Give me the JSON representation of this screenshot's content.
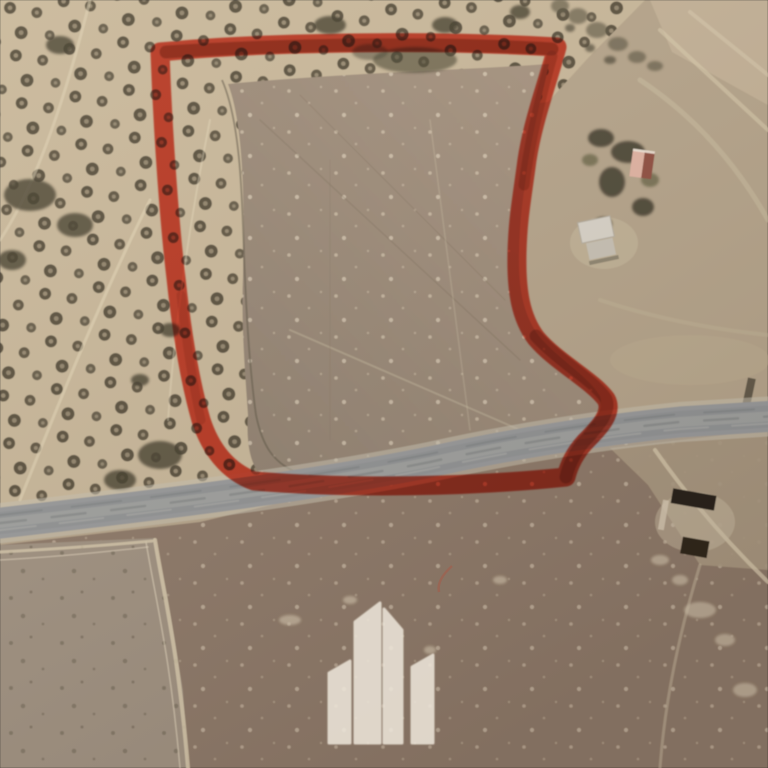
{
  "image": {
    "kind": "satellite-aerial-photo",
    "description": "Aerial view of farmland and olive groves with a red hand-drawn land parcel boundary, a grey rural road, and a white buildings watermark logo"
  },
  "parcel": {
    "path": "M 160 52 C 250 43, 420 39, 557 47 C 549 78, 533 120, 527 160 C 521 205, 518 218, 517 252 C 516 292, 521 318, 536 338 C 556 362, 592 380, 606 399 C 614 413, 598 429, 585 442 C 575 453, 569 465, 566 477 C 470 487, 350 489, 254 481 C 227 471, 210 448, 201 420 C 189 378, 181 325, 176 278 C 170 228, 163 138, 160 52 Z",
    "color": "#e8402a",
    "shadow_color": "#7e1a06",
    "stroke_width": 19
  },
  "road": {
    "path": "M -8 524 C 150 506, 300 488, 430 462 C 510 444, 600 430, 680 422 L 776 416",
    "color": "#97999b",
    "shoulder_color": "#c9c2b2"
  },
  "terrain": {
    "base_color": "#b5a48b",
    "grove_soil_color": "#c8b79a",
    "olive_tree_color": "#4c4434",
    "olive_tree_center_color": "#c9b89b",
    "parcel_field_dark": "#8f8070",
    "parcel_field_light": "#a79481",
    "plowed_field_color": "#8c7867",
    "light_field_color": "#9f9181",
    "tan_wedge_color": "#aa9982",
    "track_color": "#d8caae"
  },
  "structures": {
    "red_roof_light": "#e2b4a4",
    "red_roof_dark": "#8f4d40",
    "white_roof": "#d9d4ca",
    "white_roof_lower": "#c8c2b6",
    "shed_color": "#211c14"
  },
  "watermark": {
    "icon": "buildings-logo-icon",
    "color": "#efe8dc",
    "opacity": 0.85
  }
}
